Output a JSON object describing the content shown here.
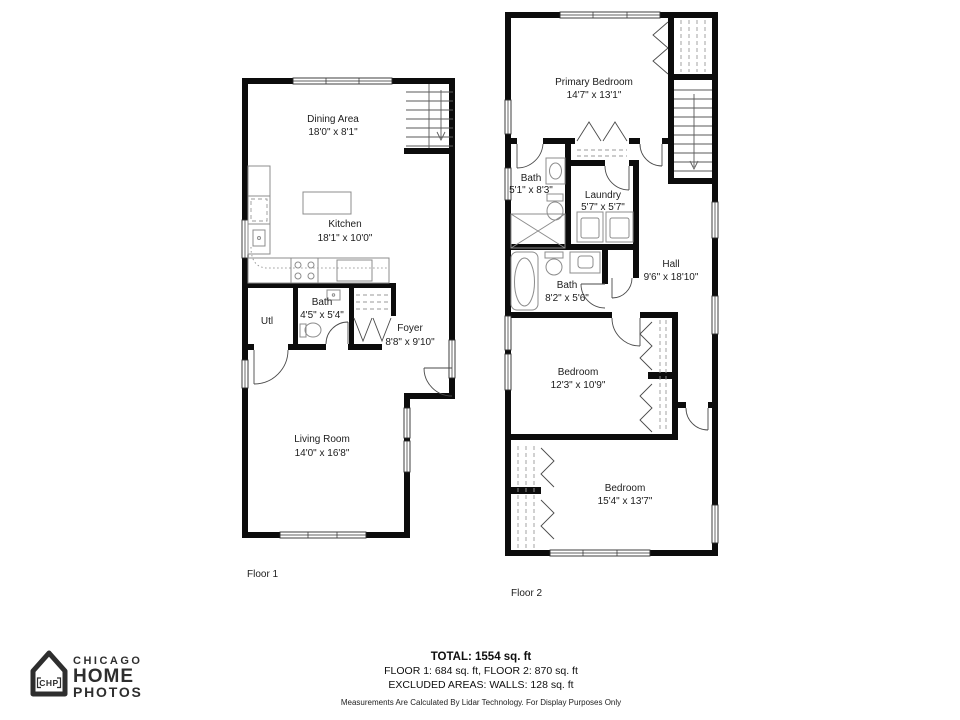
{
  "floor1": {
    "label": "Floor 1",
    "rooms": {
      "dining": {
        "name": "Dining Area",
        "dims": "18'0\" x 8'1\""
      },
      "kitchen": {
        "name": "Kitchen",
        "dims": "18'1\" x 10'0\""
      },
      "utl": {
        "name": "Utl"
      },
      "bath": {
        "name": "Bath",
        "dims": "4'5\" x 5'4\""
      },
      "foyer": {
        "name": "Foyer",
        "dims": "8'8\" x 9'10\""
      },
      "living": {
        "name": "Living Room",
        "dims": "14'0\" x 16'8\""
      }
    }
  },
  "floor2": {
    "label": "Floor 2",
    "rooms": {
      "primary": {
        "name": "Primary Bedroom",
        "dims": "14'7\" x 13'1\""
      },
      "bath1": {
        "name": "Bath",
        "dims": "5'1\" x 8'3\""
      },
      "laundry": {
        "name": "Laundry",
        "dims": "5'7\" x 5'7\""
      },
      "hall": {
        "name": "Hall",
        "dims": "9'6\" x 18'10\""
      },
      "bath2": {
        "name": "Bath",
        "dims": "8'2\" x 5'6\""
      },
      "bedroom1": {
        "name": "Bedroom",
        "dims": "12'3\" x 10'9\""
      },
      "bedroom2": {
        "name": "Bedroom",
        "dims": "15'4\" x 13'7\""
      }
    }
  },
  "footer": {
    "total": "TOTAL: 1554 sq. ft",
    "floors_line": "FLOOR 1: 684 sq. ft, FLOOR 2: 870 sq. ft",
    "excluded_line": "EXCLUDED AREAS: WALLS: 128 sq. ft",
    "disclaimer": "Measurements Are Calculated By Lidar Technology. For Display Purposes Only"
  },
  "logo": {
    "badge": "CHP",
    "line1": "CHICAGO",
    "line2": "HOME",
    "line3": "PHOTOS",
    "color": "#2e2e2e"
  },
  "colors": {
    "wall": "#0c0c0c",
    "fixture_stroke": "#8c8c8c",
    "background": "#ffffff"
  }
}
